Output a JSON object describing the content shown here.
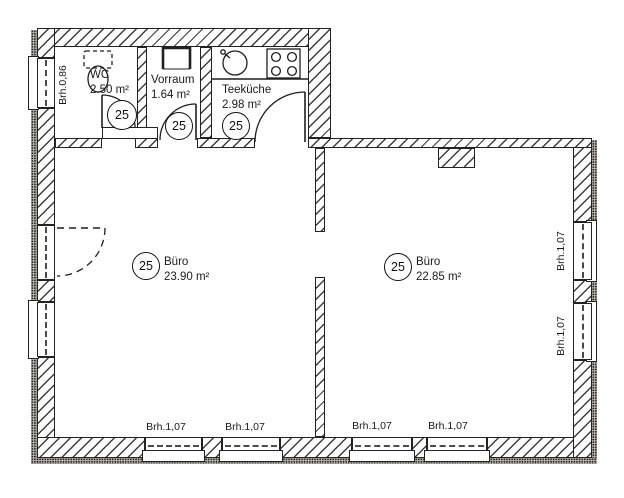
{
  "rooms": [
    {
      "name": "WC",
      "area": "2.50 m²",
      "tag": "25"
    },
    {
      "name": "Vorraum",
      "area": "1.64 m²",
      "tag": "25"
    },
    {
      "name": "Teeküche",
      "area": "2.98 m²",
      "tag": "25"
    },
    {
      "name": "Büro",
      "area": "23.90 m²",
      "tag": "25"
    },
    {
      "name": "Büro",
      "area": "22.85 m²",
      "tag": "25"
    }
  ],
  "window_labels": {
    "left": "Brh.0,86",
    "right": [
      "Brh.1,07",
      "Brh.1,07"
    ],
    "bottom": [
      "Brh.1,07",
      "Brh.1,07",
      "Brh.1,07",
      "Brh.1,07"
    ]
  },
  "colors": {
    "ink": "#1a1a1a",
    "paper": "#ffffff"
  }
}
